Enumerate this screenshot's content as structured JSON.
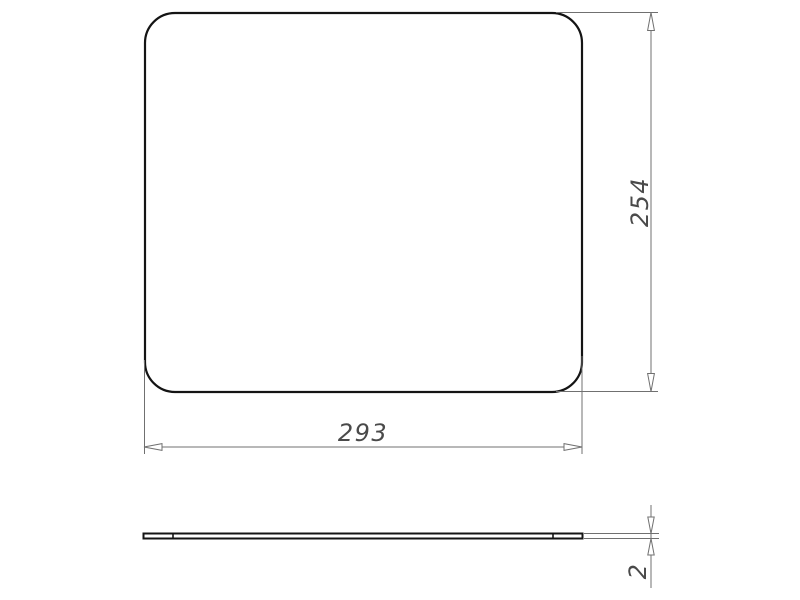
{
  "views": {
    "top_view": {
      "width_dim": {
        "value": "293",
        "orientation": "horizontal"
      },
      "height_dim": {
        "value": "254",
        "orientation": "vertical"
      }
    },
    "side_view": {
      "thickness_dim": {
        "value": "2",
        "orientation": "vertical"
      }
    }
  },
  "colors": {
    "outline": "#141414",
    "dimension_line": "#707070",
    "dimension_text": "#4a4a4a",
    "background": "#ffffff"
  }
}
